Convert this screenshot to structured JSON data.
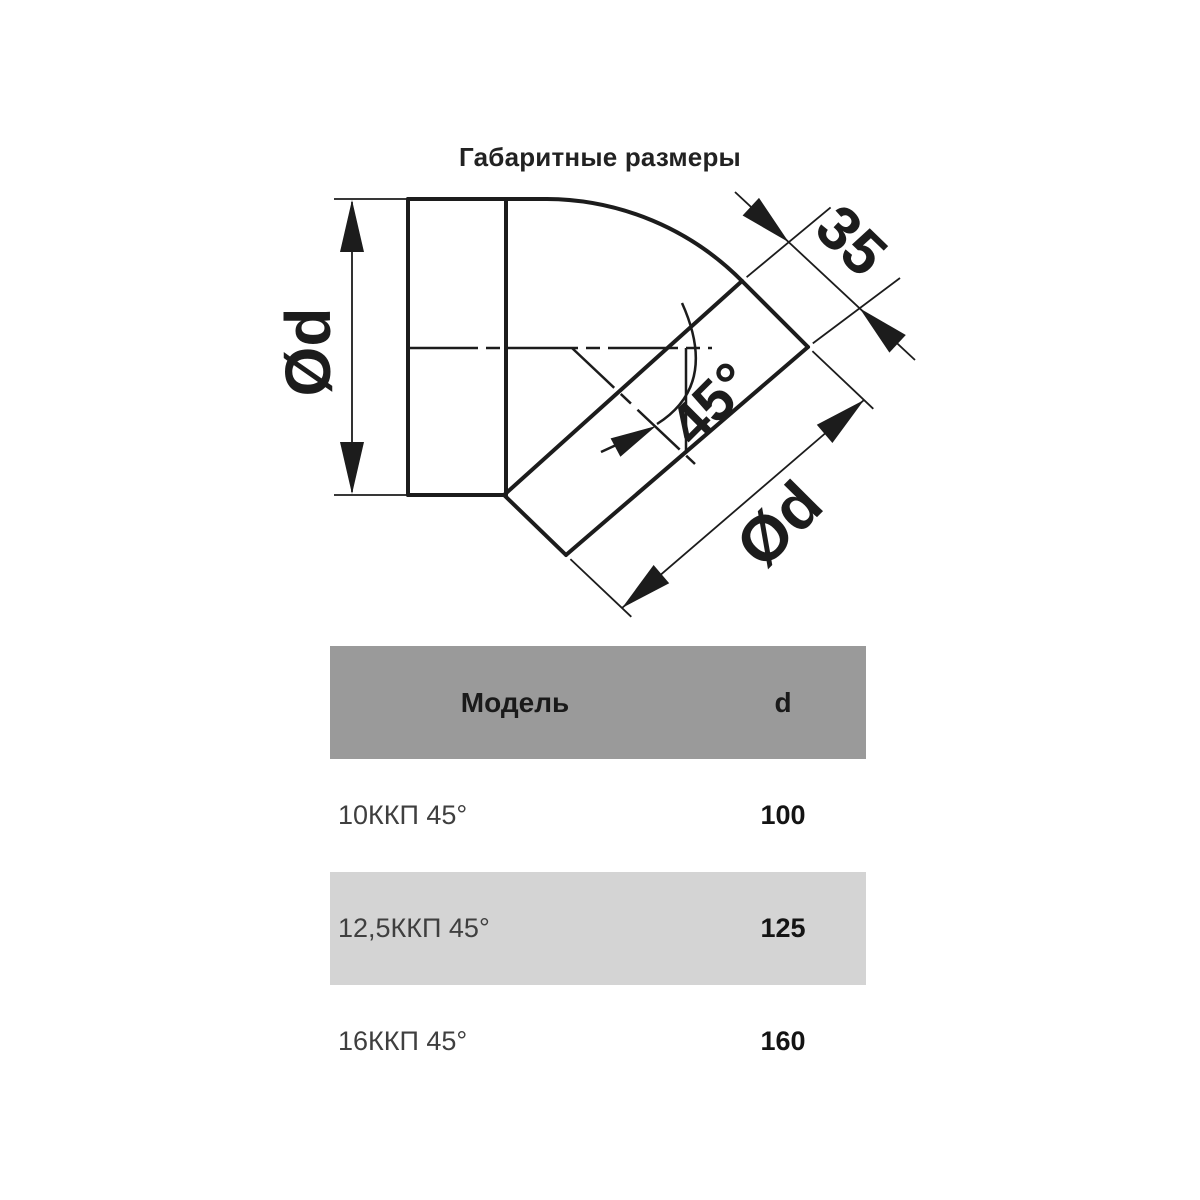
{
  "title": "Габаритные размеры",
  "drawing": {
    "dim_inlet_diameter": "Ød",
    "dim_collar_length": "35",
    "dim_angle": "45°",
    "dim_outlet_diameter": "Ød"
  },
  "table": {
    "header": {
      "model": "Модель",
      "d": "d"
    },
    "rows": [
      {
        "model": "10ККП 45°",
        "d": "100"
      },
      {
        "model": "12,5ККП 45°",
        "d": "125"
      },
      {
        "model": "16ККП 45°",
        "d": "160"
      }
    ]
  },
  "colors": {
    "line": "#1c1c1c",
    "table_header_bg": "#9a9a9a",
    "table_row_alt_bg": "#d4d4d4",
    "table_row_bg": "#ffffff"
  }
}
